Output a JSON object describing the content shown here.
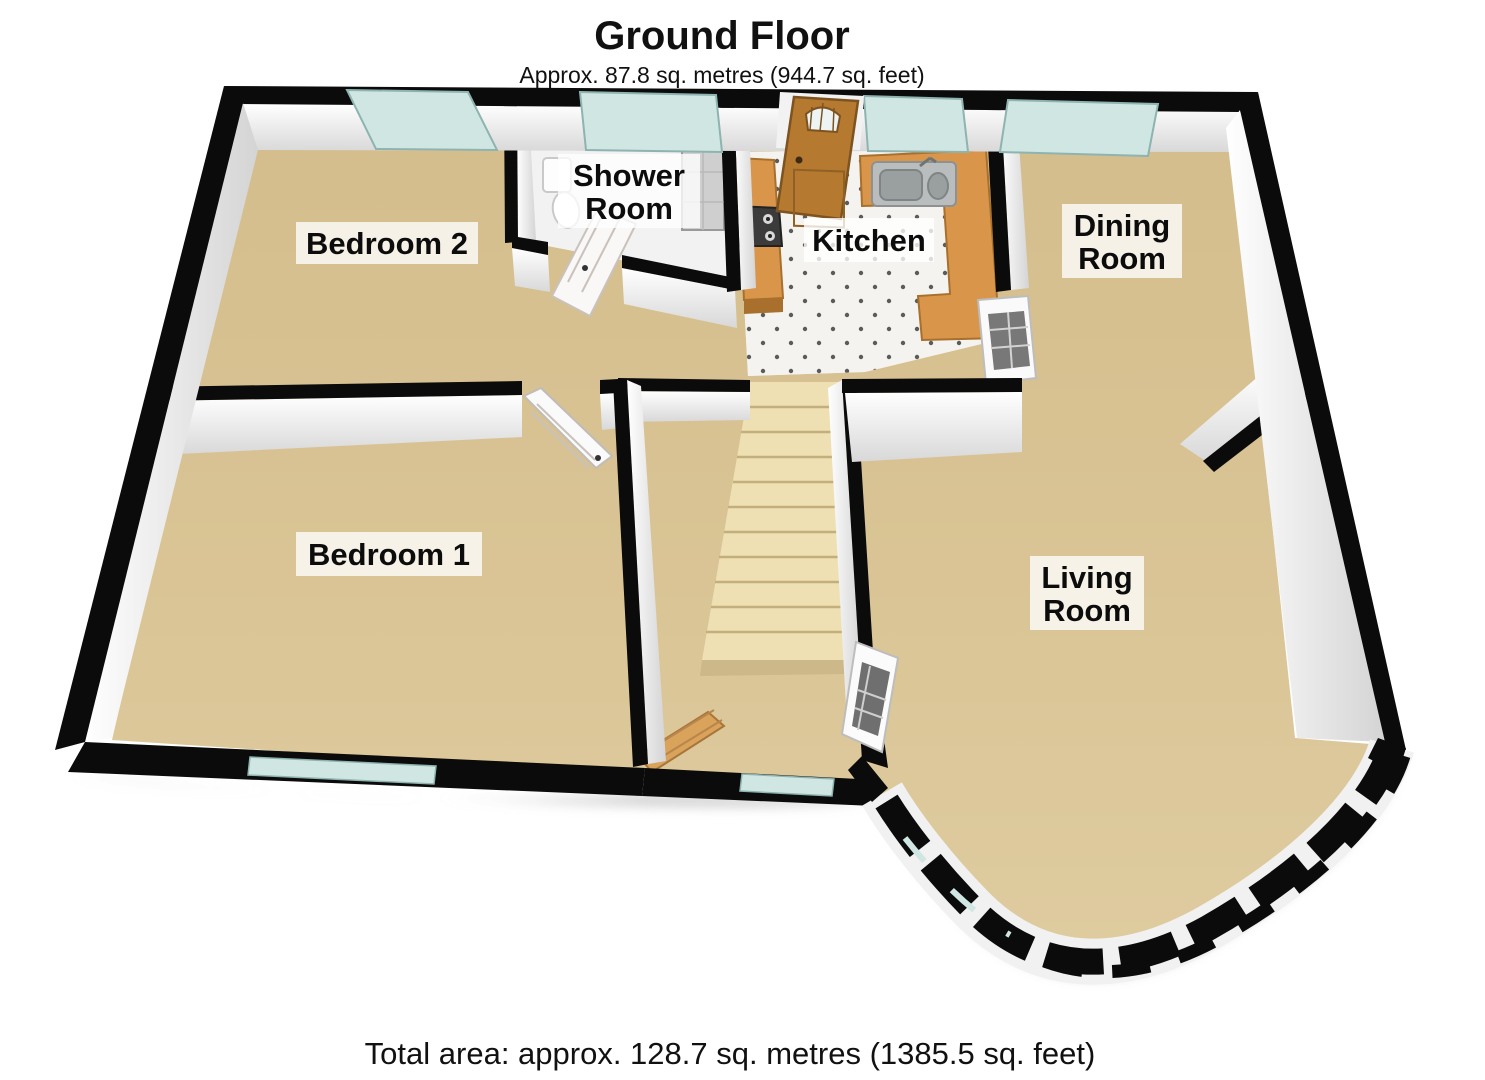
{
  "header": {
    "title": "Ground Floor",
    "subtitle": "Approx. 87.8 sq. metres (944.7 sq. feet)"
  },
  "footer": {
    "total_area": "Total area: approx. 128.7 sq. metres (1385.5 sq. feet)"
  },
  "rooms": {
    "bedroom2": {
      "label": "Bedroom 2"
    },
    "shower": {
      "line1": "Shower",
      "line2": "Room"
    },
    "kitchen": {
      "label": "Kitchen"
    },
    "dining": {
      "line1": "Dining",
      "line2": "Room"
    },
    "bedroom1": {
      "label": "Bedroom 1"
    },
    "living": {
      "line1": "Living",
      "line2": "Room"
    }
  },
  "colors": {
    "carpet": "#d8c292",
    "carpet_light": "#e6d5ab",
    "kitchen_tile": "#f4f3f0",
    "shower_floor": "#f2f2f2",
    "wall_black": "#0b0b0b",
    "window_glass": "#cfe6e3",
    "counter_wood": "#d9964a",
    "front_door_wood": "#b5792f",
    "stairs": "#eee0b2",
    "bench_wood": "#d9a35c"
  }
}
